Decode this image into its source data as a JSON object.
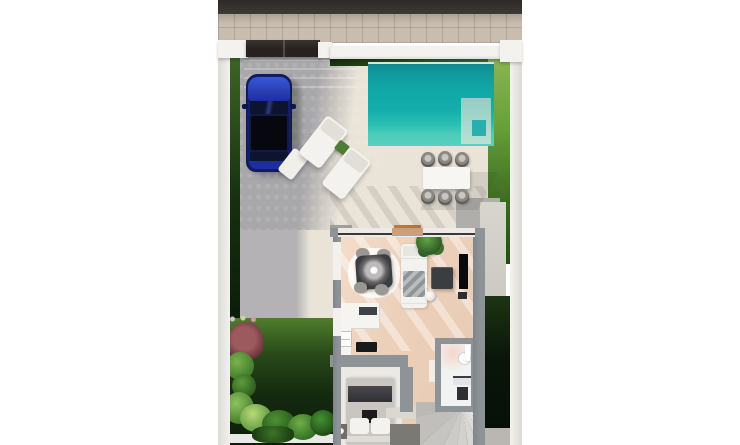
{
  "scene": {
    "type": "3d-floor-plan-render",
    "description": "Top-down photoreal render of a villa plot: street, driveway with blue car, pool terrace, one-bedroom interior, garden",
    "visible_text": ""
  },
  "labels": {
    "road": "asphalt road",
    "sidewalk": "brick sidewalk",
    "gate": "driveway sliding gate",
    "car": "blue car parked on driveway",
    "pool": "turquoise swimming pool",
    "loungers": "white sun loungers",
    "outdoor_dining": "outdoor dining table with six chairs",
    "living_room": "living room with sofa, table, TV",
    "kitchen": "kitchen counter with sink and cooktop",
    "bedroom": "bedroom with double bed and nightstands",
    "bathroom": "bathroom with shower and vanity",
    "stairs": "winder staircase",
    "garden": "tropical garden with plants"
  },
  "colors": {
    "road": "#3e3a37",
    "sidewalk": "#c9bdaf",
    "wall_white": "#f3f2ee",
    "gate_dark": "#272220",
    "hedge_dark": "#16300f",
    "hedge_mid": "#2f5a1e",
    "grass": "#8cb657",
    "driveway": "#a8a7a9",
    "patio": "#e9e3d8",
    "pool_main": "#12a7a7",
    "pool_light": "#4fccbb",
    "pool_steps": "#9fd0c6",
    "car_blue": "#152173",
    "car_roof": "#07080f",
    "porch": "#b0aeaa",
    "path_gray": "#d8d5cf",
    "paving": "#bab7b2",
    "garden_dark": "#0a150a",
    "plant_green": "#4e7d33",
    "plant_red": "#9c5a5e",
    "house_wall": "#8d9396",
    "wood": "#ecd0ba",
    "sofa": "#f4f2ee",
    "furn_dark": "#3a3e41",
    "tv": "#0a0a0c",
    "kitchen": "#f5f4f1",
    "cooktop": "#17191b",
    "bed": "#c9c6c2",
    "blanket": "#303034",
    "bath": "#f1f3f3",
    "stairs": "#dbd8d2",
    "door_tan": "#c9a07b",
    "mat_gray": "#a09e99",
    "mat_orange": "#b3703b"
  }
}
